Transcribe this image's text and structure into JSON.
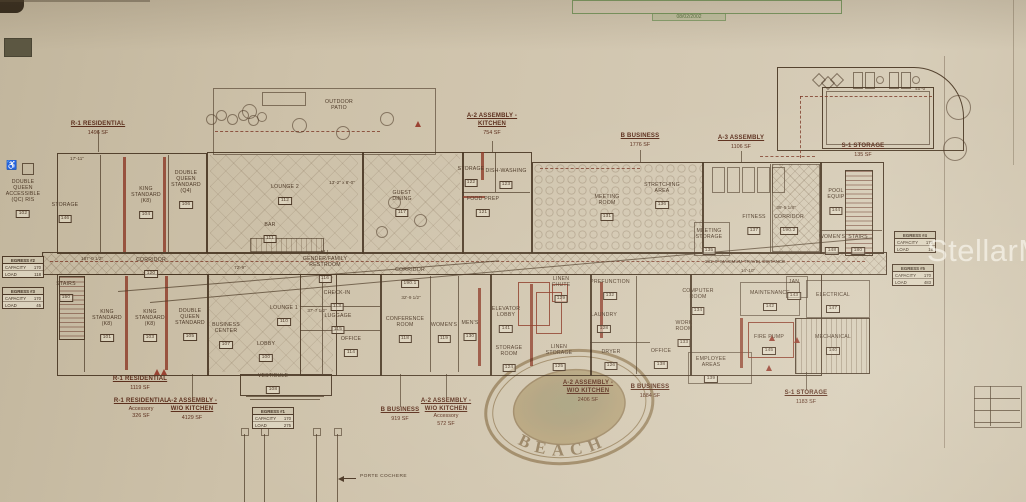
{
  "title_block": {
    "date": "08/02/2002"
  },
  "watermarks": {
    "mls": "StellarMLS",
    "seal_text": "BEACH"
  },
  "porte_cochere": {
    "label": "PORTE COCHERE"
  },
  "icons": {
    "wheelchair": "♿"
  },
  "colors": {
    "paper": "#cfc3ab",
    "ink": "#4c3826",
    "red_wall": "#8a3a28",
    "green_stamp": "#6f9157",
    "zone_text": "#5c2f1d",
    "seal_gold": "#8d6f3b",
    "watermark_white": "#fdfbf5"
  },
  "zones": {
    "top": [
      {
        "l": [
          "R-1 RESIDENTIAL"
        ],
        "sf": "1496 SF",
        "x": 98,
        "y": 121
      },
      {
        "l": [
          "A-2 ASSEMBLY -",
          "KITCHEN"
        ],
        "sf": "754 SF",
        "x": 492,
        "y": 113
      },
      {
        "l": [
          "B BUSINESS"
        ],
        "sf": "1776 SF",
        "x": 640,
        "y": 133
      },
      {
        "l": [
          "A-3 ASSEMBLY"
        ],
        "sf": "1106 SF",
        "x": 741,
        "y": 135
      },
      {
        "l": [
          "S-1 STORAGE"
        ],
        "sf": "135 SF",
        "x": 863,
        "y": 143
      }
    ],
    "bottom": [
      {
        "l": [
          "R-1 RESIDENTIAL"
        ],
        "sf": "1119 SF",
        "x": 140,
        "y": 376
      },
      {
        "l": [
          "R-1 RESIDENTIAL"
        ],
        "sub": "Accessory",
        "sf": "326 SF",
        "x": 141,
        "y": 398
      },
      {
        "l": [
          "A-2 ASSEMBLY -",
          "W/O KITCHEN"
        ],
        "sf": "4129 SF",
        "x": 192,
        "y": 398
      },
      {
        "l": [
          "B BUSINESS"
        ],
        "sf": "919 SF",
        "x": 400,
        "y": 407
      },
      {
        "l": [
          "A-2 ASSEMBLY -",
          "W/O KITCHEN"
        ],
        "sub": "Accessory",
        "sf": "572 SF",
        "x": 446,
        "y": 398
      },
      {
        "l": [
          "A-2 ASSEMBLY -",
          "W/O KITCHEN"
        ],
        "sf": "2406 SF",
        "x": 588,
        "y": 380
      },
      {
        "l": [
          "B BUSINESS"
        ],
        "sf": "1884 SF",
        "x": 650,
        "y": 384
      },
      {
        "l": [
          "S-1 STORAGE"
        ],
        "sf": "1183 SF",
        "x": 806,
        "y": 390
      }
    ]
  },
  "rooms": [
    {
      "l": [
        "DOUBLE",
        "QUEEN",
        "ACCESSIBLE",
        "(QC) RIS"
      ],
      "n": "102",
      "x": 23,
      "y": 179
    },
    {
      "l": [
        "STORAGE"
      ],
      "n": "146",
      "x": 65,
      "y": 202
    },
    {
      "l": [
        "KING",
        "STANDARD",
        "(K8)"
      ],
      "n": "104",
      "x": 146,
      "y": 186
    },
    {
      "l": [
        "DOUBLE",
        "QUEEN",
        "STANDARD",
        "(Q4)"
      ],
      "n": "106",
      "x": 186,
      "y": 170
    },
    {
      "l": [
        "LOUNGE 2"
      ],
      "n": "112",
      "x": 285,
      "y": 184
    },
    {
      "l": [
        "BAR"
      ],
      "n": "111",
      "x": 270,
      "y": 222
    },
    {
      "l": [
        "GUEST",
        "DINING"
      ],
      "n": "117",
      "x": 402,
      "y": 190
    },
    {
      "l": [
        "OUTDOOR",
        "PATIO"
      ],
      "n": "",
      "x": 339,
      "y": 99
    },
    {
      "l": [
        "STORAGE"
      ],
      "n": "122",
      "x": 471,
      "y": 166
    },
    {
      "l": [
        "DISH-WASHING"
      ],
      "n": "123",
      "x": 506,
      "y": 168
    },
    {
      "l": [
        "FOOD PREP"
      ],
      "n": "121",
      "x": 483,
      "y": 196
    },
    {
      "l": [
        "MEETING",
        "ROOM"
      ],
      "n": "131",
      "x": 607,
      "y": 194
    },
    {
      "l": [
        "STRETCHING",
        "AREA"
      ],
      "n": "136",
      "x": 662,
      "y": 182
    },
    {
      "l": [
        "MEETING",
        "STORAGE"
      ],
      "n": "135",
      "x": 709,
      "y": 228
    },
    {
      "l": [
        "FITNESS"
      ],
      "n": "137",
      "x": 754,
      "y": 214
    },
    {
      "l": [
        "CORRIDOR"
      ],
      "n": "190.2",
      "x": 789,
      "y": 214
    },
    {
      "l": [
        "POOL",
        "EQUIP"
      ],
      "n": "144",
      "x": 836,
      "y": 188
    },
    {
      "l": [
        "WOMEN'S"
      ],
      "n": "148",
      "x": 832,
      "y": 234
    },
    {
      "l": [
        "STAIRS"
      ],
      "n": "180",
      "x": 858,
      "y": 234
    },
    {
      "l": [
        "CORRIDOR"
      ],
      "n": "120",
      "x": 151,
      "y": 257
    },
    {
      "l": [
        "ALL",
        "GENDER/FAMILY",
        "RESTROOM"
      ],
      "n": "116",
      "x": 325,
      "y": 250
    },
    {
      "l": [
        "CORRIDOR"
      ],
      "n": "190.1",
      "x": 410,
      "y": 267
    },
    {
      "l": [
        "STAIRS"
      ],
      "n": "150",
      "x": 66,
      "y": 281
    },
    {
      "l": [
        "KING",
        "STANDARD",
        "(K8)"
      ],
      "n": "101",
      "x": 107,
      "y": 309
    },
    {
      "l": [
        "KING",
        "STANDARD",
        "(K8)"
      ],
      "n": "103",
      "x": 150,
      "y": 309
    },
    {
      "l": [
        "DOUBLE",
        "QUEEN",
        "STANDARD"
      ],
      "n": "105",
      "x": 190,
      "y": 308
    },
    {
      "l": [
        "BUSINESS",
        "CENTER"
      ],
      "n": "107",
      "x": 226,
      "y": 322
    },
    {
      "l": [
        "LOUNGE 1"
      ],
      "n": "110",
      "x": 284,
      "y": 305
    },
    {
      "l": [
        "LOBBY"
      ],
      "n": "100",
      "x": 266,
      "y": 341
    },
    {
      "l": [
        "VESTIBULE"
      ],
      "n": "108",
      "x": 273,
      "y": 373
    },
    {
      "l": [
        "CHECK-IN"
      ],
      "n": "113",
      "x": 337,
      "y": 290
    },
    {
      "l": [
        "LUGGAGE"
      ],
      "n": "115",
      "x": 338,
      "y": 313
    },
    {
      "l": [
        "OFFICE"
      ],
      "n": "114",
      "x": 351,
      "y": 336
    },
    {
      "l": [
        "CONFERENCE",
        "ROOM"
      ],
      "n": "118",
      "x": 405,
      "y": 316
    },
    {
      "l": [
        "WOMEN'S"
      ],
      "n": "119",
      "x": 444,
      "y": 322
    },
    {
      "l": [
        "MEN'S"
      ],
      "n": "130",
      "x": 470,
      "y": 320
    },
    {
      "l": [
        "ELEVATOR",
        "LOBBY"
      ],
      "n": "141",
      "x": 506,
      "y": 306
    },
    {
      "l": [
        "LINEN",
        "CHUTE"
      ],
      "n": "129",
      "x": 561,
      "y": 276
    },
    {
      "l": [
        "PREFUNCTION"
      ],
      "n": "132",
      "x": 610,
      "y": 279
    },
    {
      "l": [
        "LAUNDRY"
      ],
      "n": "128",
      "x": 604,
      "y": 312
    },
    {
      "l": [
        "LINEN",
        "STORAGE"
      ],
      "n": "125",
      "x": 559,
      "y": 344
    },
    {
      "l": [
        "DRYER"
      ],
      "n": "126",
      "x": 611,
      "y": 349
    },
    {
      "l": [
        "STORAGE",
        "ROOM"
      ],
      "n": "124",
      "x": 509,
      "y": 345
    },
    {
      "l": [
        "WORK",
        "ROOM"
      ],
      "n": "133",
      "x": 684,
      "y": 320
    },
    {
      "l": [
        "OFFICE"
      ],
      "n": "138",
      "x": 661,
      "y": 348
    },
    {
      "l": [
        "COMPUTER",
        "ROOM"
      ],
      "n": "134",
      "x": 698,
      "y": 288
    },
    {
      "l": [
        "MAINTENANCE"
      ],
      "n": "142",
      "x": 770,
      "y": 290
    },
    {
      "l": [
        "JAN"
      ],
      "n": "143",
      "x": 794,
      "y": 279
    },
    {
      "l": [
        "ELECTRICAL"
      ],
      "n": "147",
      "x": 833,
      "y": 292
    },
    {
      "l": [
        "FIRE PUMP"
      ],
      "n": "145",
      "x": 769,
      "y": 334
    },
    {
      "l": [
        "MECHANICAL"
      ],
      "n": "140",
      "x": 833,
      "y": 334
    },
    {
      "l": [
        "EMPLOYEE",
        "AREAS"
      ],
      "n": "139",
      "x": 711,
      "y": 356
    }
  ],
  "egress": [
    {
      "hdr": "EGRESS #2",
      "capacity_label": "CAPACITY",
      "capacity": "170",
      "load_label": "LOAD",
      "load": "118",
      "x": 2,
      "y": 256
    },
    {
      "hdr": "EGRESS #3",
      "capacity_label": "CAPACITY",
      "capacity": "170",
      "load_label": "LOAD",
      "load": "45",
      "x": 2,
      "y": 287
    },
    {
      "hdr": "EGRESS #1",
      "capacity_label": "CAPACITY",
      "capacity": "170",
      "load_label": "LOAD",
      "load": "275",
      "x": 252,
      "y": 407
    },
    {
      "hdr": "EGRESS #4",
      "capacity_label": "CAPACITY",
      "capacity": "170",
      "load_label": "LOAD",
      "load": "19",
      "x": 894,
      "y": 231
    },
    {
      "hdr": "EGRESS #5",
      "capacity_label": "CAPACITY",
      "capacity": "170",
      "load_label": "LOAD",
      "load": "483",
      "x": 892,
      "y": 264
    }
  ],
  "notes": [
    {
      "t": "181'-6\" MAXIMUM TRAVEL DISTANCE",
      "x": 745,
      "y": 259
    },
    {
      "t": "187'-0 1/2\"",
      "x": 92,
      "y": 256
    },
    {
      "t": "72'-9\"",
      "x": 240,
      "y": 265
    },
    {
      "t": "40'-0\"",
      "x": 921,
      "y": 86
    },
    {
      "t": "39'-5 1/8\"",
      "x": 786,
      "y": 205
    },
    {
      "t": "13'-2\" x 8'-0\"",
      "x": 342,
      "y": 180
    },
    {
      "t": "37'-7 1/2\"",
      "x": 317,
      "y": 308
    },
    {
      "t": "32'-9 1/2\"",
      "x": 411,
      "y": 295
    },
    {
      "t": "17'-11\"",
      "x": 77,
      "y": 156
    },
    {
      "t": "14'-10\"",
      "x": 748,
      "y": 268
    }
  ]
}
